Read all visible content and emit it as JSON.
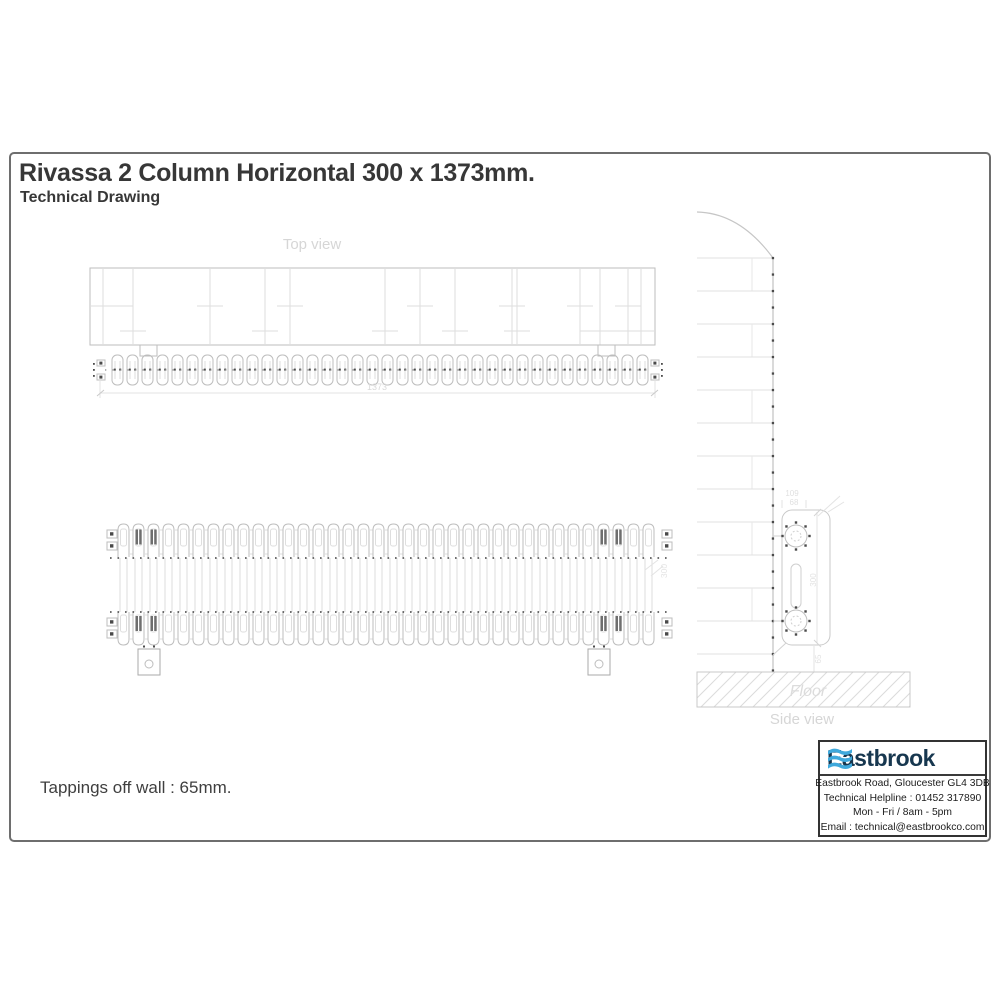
{
  "header": {
    "title": "Rivassa 2 Column Horizontal 300 x 1373mm.",
    "subtitle": "Technical Drawing"
  },
  "note": "Tappings off wall : 65mm.",
  "views": {
    "top": {
      "label": "Top view",
      "length_dim": "1373",
      "columns": 36
    },
    "front": {
      "height_dim": "300",
      "columns": 36
    },
    "side": {
      "label": "Side view",
      "floor_label": "Floor",
      "depth_dim": "109",
      "wall_to_tapping_dim": "68",
      "height_dim": "300",
      "floor_gap_dim": "65",
      "wall_courses": 13
    }
  },
  "brand": {
    "name": "Eastbrook",
    "address": "Eastbrook Road, Gloucester GL4 3DB",
    "helpline": "Technical Helpline : 01452 317890",
    "hours": "Mon - Fri / 8am - 5pm",
    "email": "Email : technical@eastbrookco.com",
    "name_color": "#17374f",
    "wave_color": "#3fa9dc"
  },
  "colors": {
    "drawing_line": "#d2d2d2",
    "drawing_dark": "#4a4a4a",
    "label_gray": "#d6d6d6",
    "frame_gray": "#6e6e6e"
  }
}
